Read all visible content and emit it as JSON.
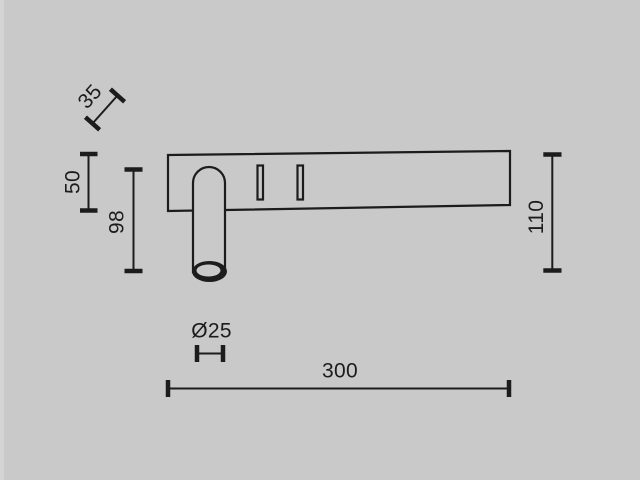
{
  "meta": {
    "description": "Technical dimension drawing (side view) of a wall-mounted reading light: rectangular backplate with two mounting slots and a downward cylindrical spot tube",
    "background_color": "#c9c9c9",
    "line_color": "#1c1c1c",
    "units": "mm (implied, unlabeled)"
  },
  "dimensions": {
    "bracket_depth": "35",
    "plate_height": "50",
    "tube_length": "98",
    "overall_height": "110",
    "tube_diameter": "Ø25",
    "overall_width": "300"
  }
}
